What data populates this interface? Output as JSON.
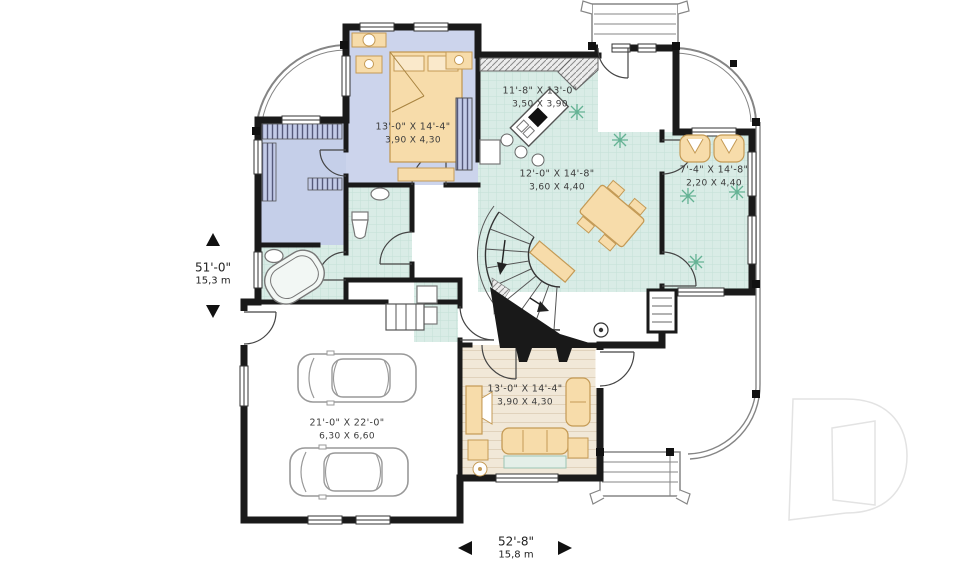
{
  "plan": {
    "rooms": [
      {
        "id": "bedroom",
        "imperial": "13'-0\" X 14'-4\"",
        "metric": "3,90 X 4,30"
      },
      {
        "id": "kitchen",
        "imperial": "11'-8\" X 13'-0\"",
        "metric": "3,50 X 3,90"
      },
      {
        "id": "dining",
        "imperial": "12'-0\" X 14'-8\"",
        "metric": "3,60 X 4,40"
      },
      {
        "id": "sunroom",
        "imperial": "7'-4\" X 14'-8\"",
        "metric": "2,20 X 4,40"
      },
      {
        "id": "living",
        "imperial": "13'-0\" X 14'-4\"",
        "metric": "3,90 X 4,30"
      },
      {
        "id": "garage",
        "imperial": "21'-0\" X 22'-0\"",
        "metric": "6,30 X 6,60"
      }
    ],
    "overall_dimensions": {
      "height_imperial": "51'-0\"",
      "height_metric": "15,3 m",
      "width_imperial": "52'-8\"",
      "width_metric": "15,8 m"
    },
    "watermark": {
      "icon": "drummond-d-logo"
    },
    "colors": {
      "bedroom_floor": "#ccd4ec",
      "tile_floor": "#d9ece6",
      "wood_floor": "#f1e8d8",
      "furniture": "#f7dcaa",
      "walls": "#1a1a1a",
      "railing": "#8d8d8d",
      "watermark": "#e6e6e6"
    }
  }
}
